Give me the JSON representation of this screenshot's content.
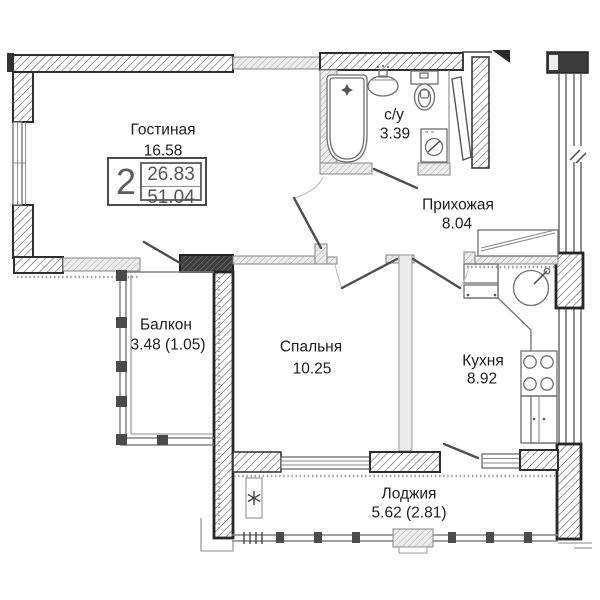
{
  "plan": {
    "title": "2-room apartment floor plan",
    "badge": {
      "rooms_count": "2",
      "living_area": "26.83",
      "total_area": "51.04"
    },
    "rooms": [
      {
        "id": "living-room",
        "name": "Гостиная",
        "area": "16.58"
      },
      {
        "id": "bathroom",
        "name": "с/у",
        "area": "3.39"
      },
      {
        "id": "hallway",
        "name": "Прихожая",
        "area": "8.04"
      },
      {
        "id": "balcony",
        "name": "Балкон",
        "area": "3.48 (1.05)"
      },
      {
        "id": "bedroom",
        "name": "Спальня",
        "area": "10.25"
      },
      {
        "id": "kitchen",
        "name": "Кухня",
        "area": "8.92"
      },
      {
        "id": "loggia",
        "name": "Лоджия",
        "area": "5.62 (2.81)"
      }
    ],
    "fixtures": [
      "bathtub-icon",
      "bath-sink-icon",
      "toilet-icon",
      "washing-machine-icon",
      "kitchen-sink-icon",
      "stove-icon",
      "kitchen-cabinet-icon",
      "wardrobe-icon",
      "radiator-icon",
      "entrance-arrow-icon"
    ],
    "colors": {
      "wall_outline": "#2e2e2e",
      "wall_dark": "#3e3e3e",
      "hatch": "#4f4f4f",
      "interior_wall": "#ececec",
      "text": "#1d1d1d"
    }
  }
}
